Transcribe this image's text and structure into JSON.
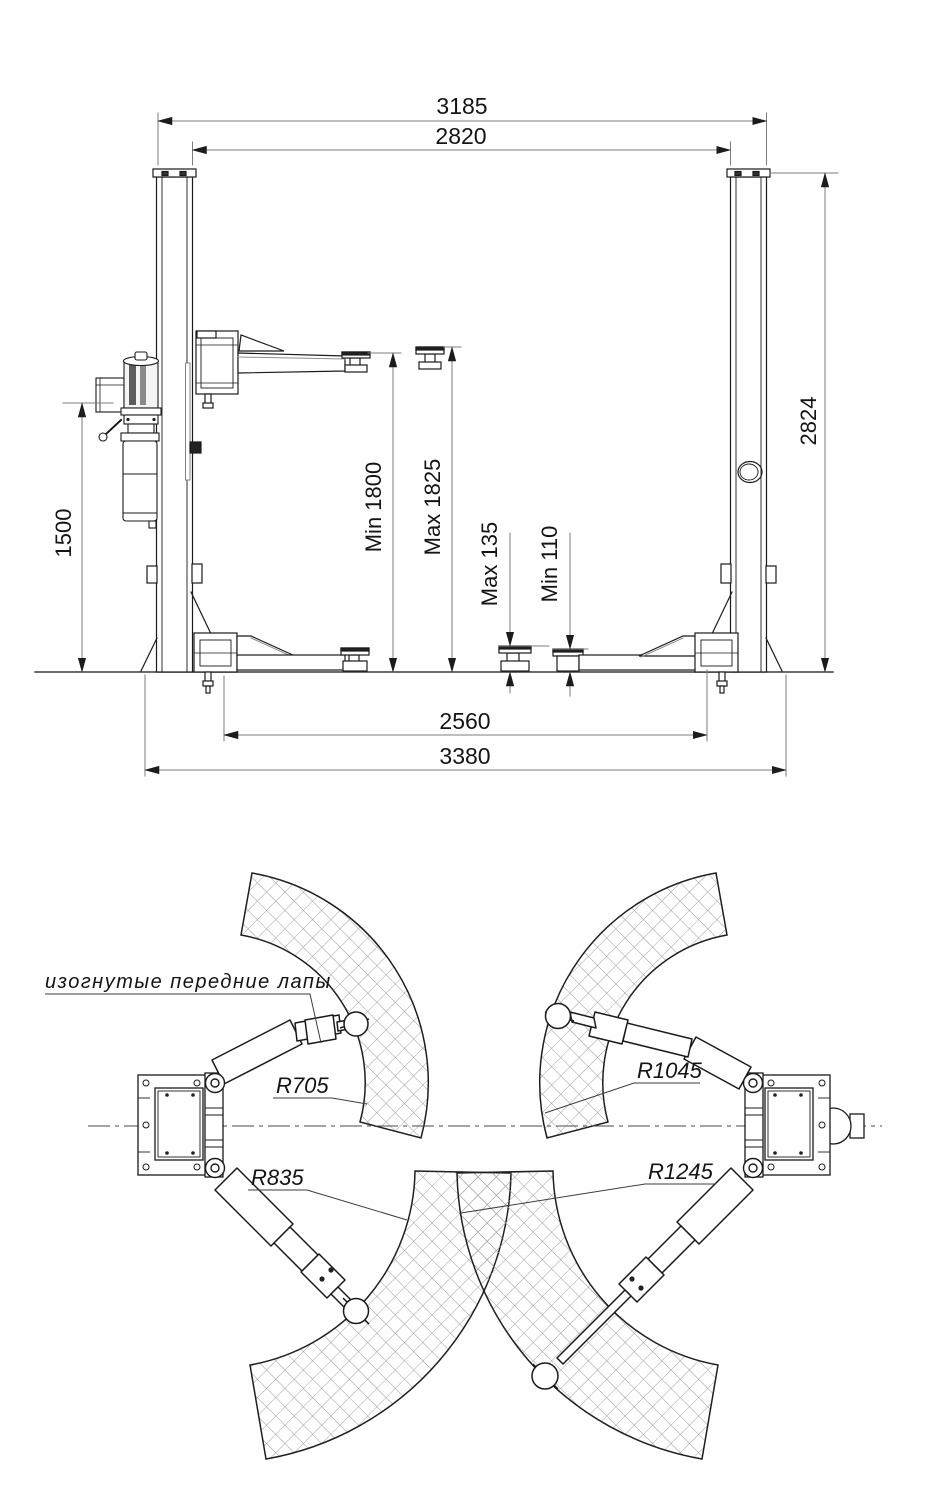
{
  "drawing": {
    "type": "two-post car lift installation drawing",
    "views": [
      "front elevation with dimensions",
      "plan view of swing arms with reach radii"
    ]
  },
  "front_view": {
    "dim_width_overall_top": "3185",
    "dim_width_between_columns": "2820",
    "dim_column_height": "2824",
    "dim_power_unit_height": "1500",
    "dim_lift_height_min": "Min 1800",
    "dim_lift_height_max": "Max 1825",
    "dim_pad_height_max": "Max 135",
    "dim_pad_height_min": "Min 110",
    "dim_span_inner_bottom": "2560",
    "dim_span_overall_bottom": "3380"
  },
  "top_view": {
    "label_front_arms": "изогнутые передние лапы",
    "radius_front_arm_min": "R705",
    "radius_rear_arm_min": "R835",
    "radius_front_arm_max": "R1045",
    "radius_rear_arm_max": "R1245"
  },
  "colors": {
    "line": "#1a1a1a",
    "dimension_line": "#7d7d7d",
    "arrow": "#1c1c1c",
    "hatch": "#9a9a9a",
    "background": "#ffffff"
  }
}
